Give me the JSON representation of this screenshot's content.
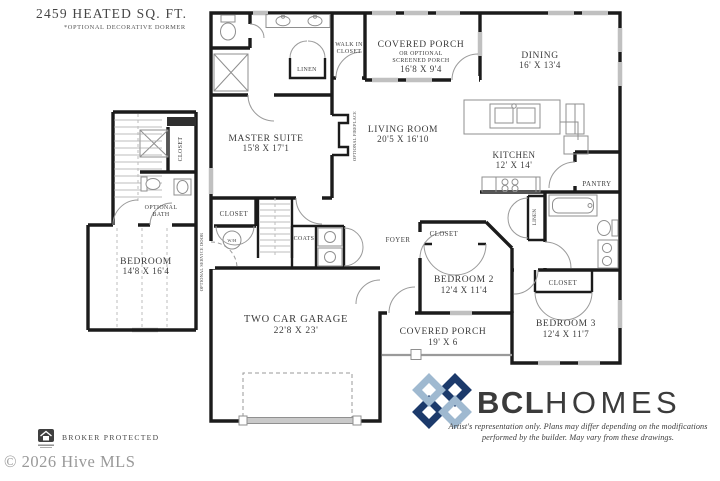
{
  "header": {
    "sqft": "2459 HEATED SQ. FT.",
    "dormer_note": "*OPTIONAL DECORATIVE DORMER"
  },
  "rooms": {
    "porch_top": {
      "name": "COVERED PORCH",
      "sub1": "OR OPTIONAL",
      "sub2": "SCREENED PORCH",
      "dims": "16'8 X 9'4"
    },
    "dining": {
      "name": "DINING",
      "dims": "16' X 13'4"
    },
    "wic1": "WALK IN",
    "wic2": "CLOSET",
    "linen_master": "LINEN",
    "master": {
      "name": "MASTER SUITE",
      "dims": "15'8 X 17'1"
    },
    "living": {
      "name": "LIVING ROOM",
      "dims": "20'5 X 16'10"
    },
    "fireplace": "OPTIONAL FIREPLACE",
    "kitchen": {
      "name": "KITCHEN",
      "dims": "12' X 14'"
    },
    "pantry": "PANTRY",
    "foyer": "FOYER",
    "hall_closet": "CLOSET",
    "coats": "COATS",
    "wh": "W/H",
    "service_door": "OPTIONAL SERVICE DOOR",
    "garage": {
      "name": "TWO CAR GARAGE",
      "dims": "22'8 X 23'"
    },
    "b2_closet": "CLOSET",
    "bedroom2": {
      "name": "BEDROOM 2",
      "dims": "12'4 X 11'4"
    },
    "linen_hall": "LINEN",
    "b3_closet": "CLOSET",
    "bedroom3": {
      "name": "BEDROOM 3",
      "dims": "12'4 X 11'7"
    },
    "porch_bottom": {
      "name": "COVERED PORCH",
      "dims": "19' X 6"
    },
    "wing_closet": "CLOSET",
    "optional_bath1": "OPTIONAL",
    "optional_bath2": "BATH",
    "wing_bedroom": {
      "name": "BEDROOM",
      "dims": "14'8 X 16'4"
    }
  },
  "branding": {
    "logo_text_1": "BCL",
    "logo_text_2": "HOMES",
    "disclaimer1": "Artist's representation only. Plans may differ depending on the modifications",
    "disclaimer2": "performed by the builder. May vary from these drawings.",
    "colors": {
      "navy": "#1c3a6b",
      "light_blue": "#9fb9d0",
      "red": "#bf4f44"
    }
  },
  "footer": {
    "broker": "BROKER PROTECTED",
    "copyright": "© 2026 Hive MLS"
  }
}
